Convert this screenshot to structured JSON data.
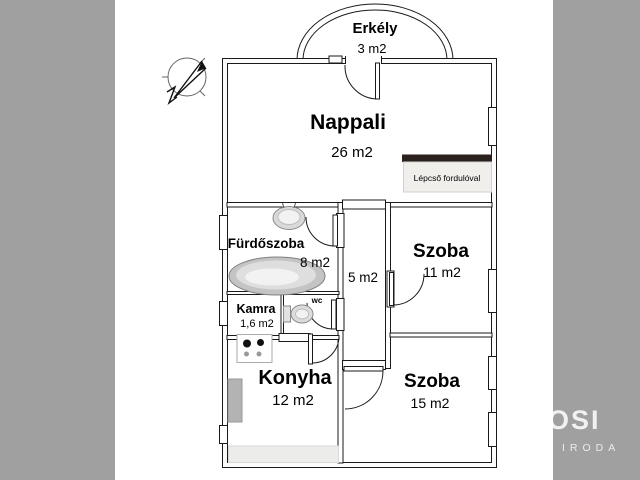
{
  "rooms": {
    "balcony": {
      "name": "Erkély",
      "area": "3 m2"
    },
    "living": {
      "name": "Nappali",
      "area": "26 m2"
    },
    "bathroom": {
      "name": "Fürdőszoba",
      "area": "8 m2"
    },
    "pantry": {
      "name": "Kamra",
      "area": "1,6 m2"
    },
    "wc": {
      "name": "wc"
    },
    "hall": {
      "area": "5 m2"
    },
    "room_small": {
      "name": "Szoba",
      "area": "11 m2"
    },
    "kitchen": {
      "name": "Konyha",
      "area": "12 m2"
    },
    "room_large": {
      "name": "Szoba",
      "area": "15 m2"
    }
  },
  "annotations": {
    "stairs_note": "Lépcső fordulóval"
  },
  "watermark": {
    "primary": "OSI",
    "secondary": "IRODA"
  },
  "icons": {
    "compass": "north-arrow-icon"
  },
  "colors": {
    "side_band": "#a0a0a0",
    "wall_line": "#1a1a1a",
    "stairs_bar": "#2b211c",
    "stairs_box": "#f1efec",
    "counter_dark": "#b3b3b3",
    "counter_light": "#ececea",
    "watermark_text": "rgba(255,255,255,0.85)"
  }
}
